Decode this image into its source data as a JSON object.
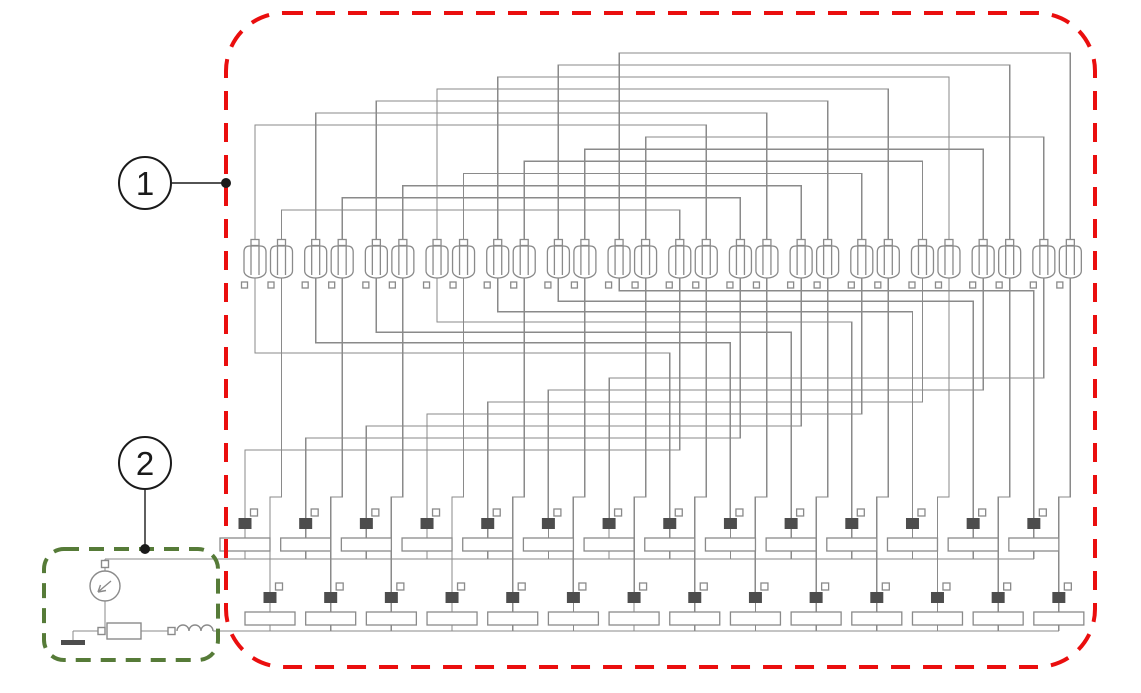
{
  "diagram": {
    "type": "circuit-schematic",
    "callouts": [
      {
        "label": "1",
        "target": "winding-network-region"
      },
      {
        "label": "2",
        "target": "source-branch-region"
      }
    ],
    "colors": {
      "region1_border": "#ea0e0e",
      "region2_border": "#567b38",
      "wire": "#8a8a8a",
      "terminal_fill": "#4d4d4d",
      "annotation": "#1a1a1a",
      "background": "#ffffff"
    },
    "structure": {
      "winding_pairs": 14,
      "windings_total": 28,
      "cell_rows": 2,
      "cells_per_row": 14,
      "top_link_tracks": 14,
      "bottom_link_tracks": 14
    },
    "source_branch": {
      "components": [
        "voltage-source",
        "ground",
        "resistor",
        "inductor"
      ]
    }
  }
}
